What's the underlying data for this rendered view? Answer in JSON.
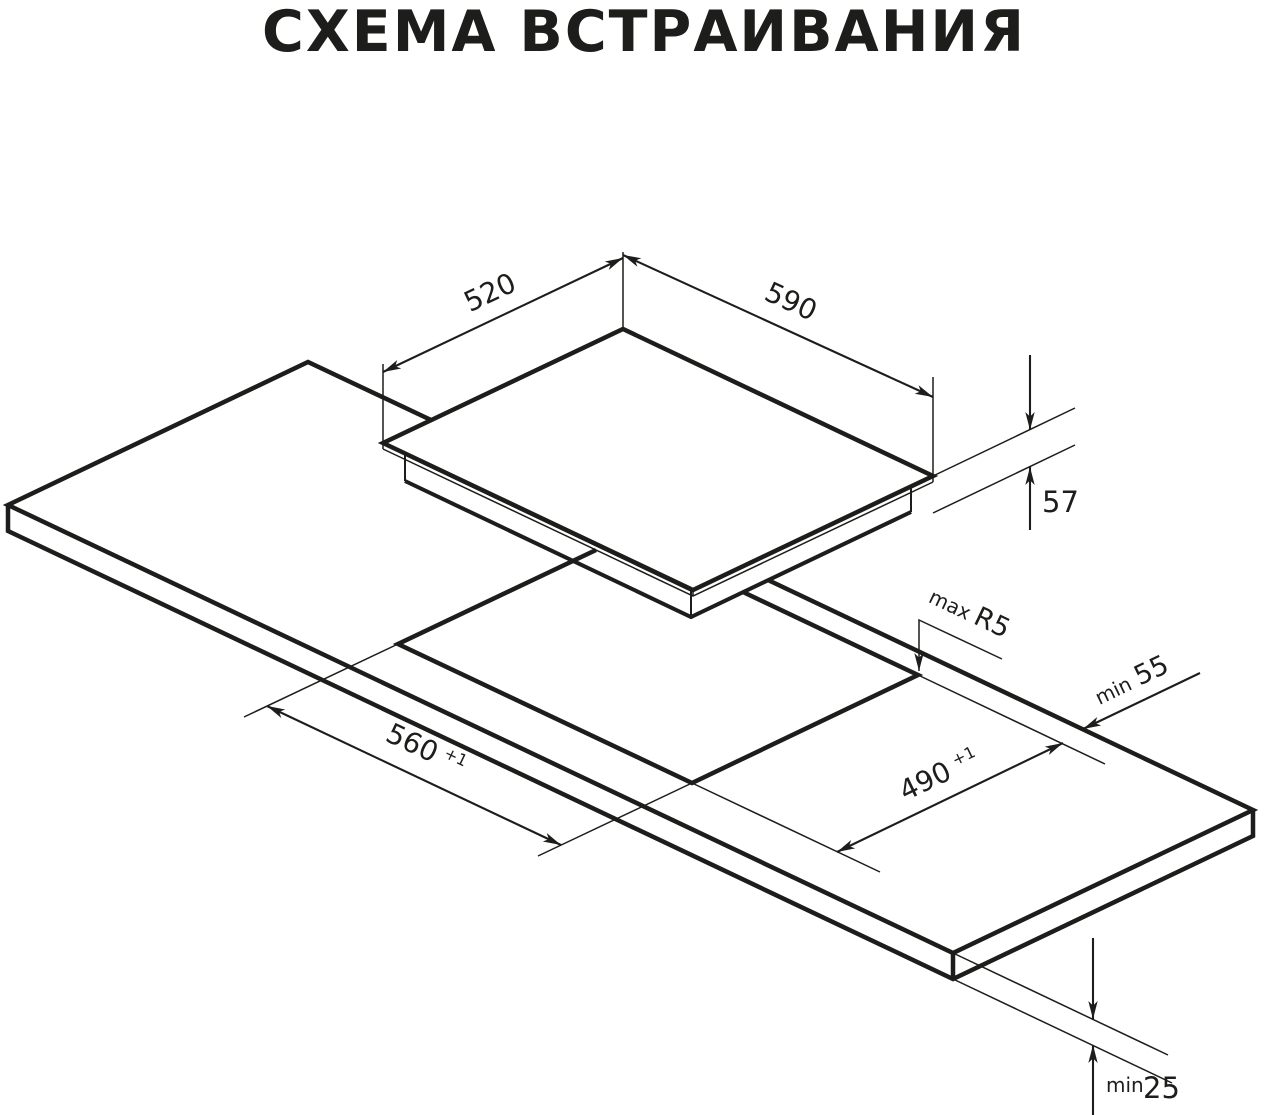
{
  "title": "СХЕМА ВСТРАИВАНИЯ",
  "diagram": {
    "description": "Isometric built-in installation diagram of a cooktop above a worktop cutout",
    "dimensions": {
      "cooktop_width": {
        "value": "520"
      },
      "cooktop_length": {
        "value": "590"
      },
      "cooktop_height": {
        "value": "57"
      },
      "cutout_corner_radius": {
        "prefix": "max",
        "value": "R5"
      },
      "rear_edge_distance": {
        "prefix": "min",
        "value": "55"
      },
      "cutout_length": {
        "value": "560",
        "tolerance": "+1"
      },
      "cutout_width": {
        "value": "490",
        "tolerance": "+1"
      },
      "worktop_thickness": {
        "prefix": "min",
        "value": "25"
      }
    }
  }
}
